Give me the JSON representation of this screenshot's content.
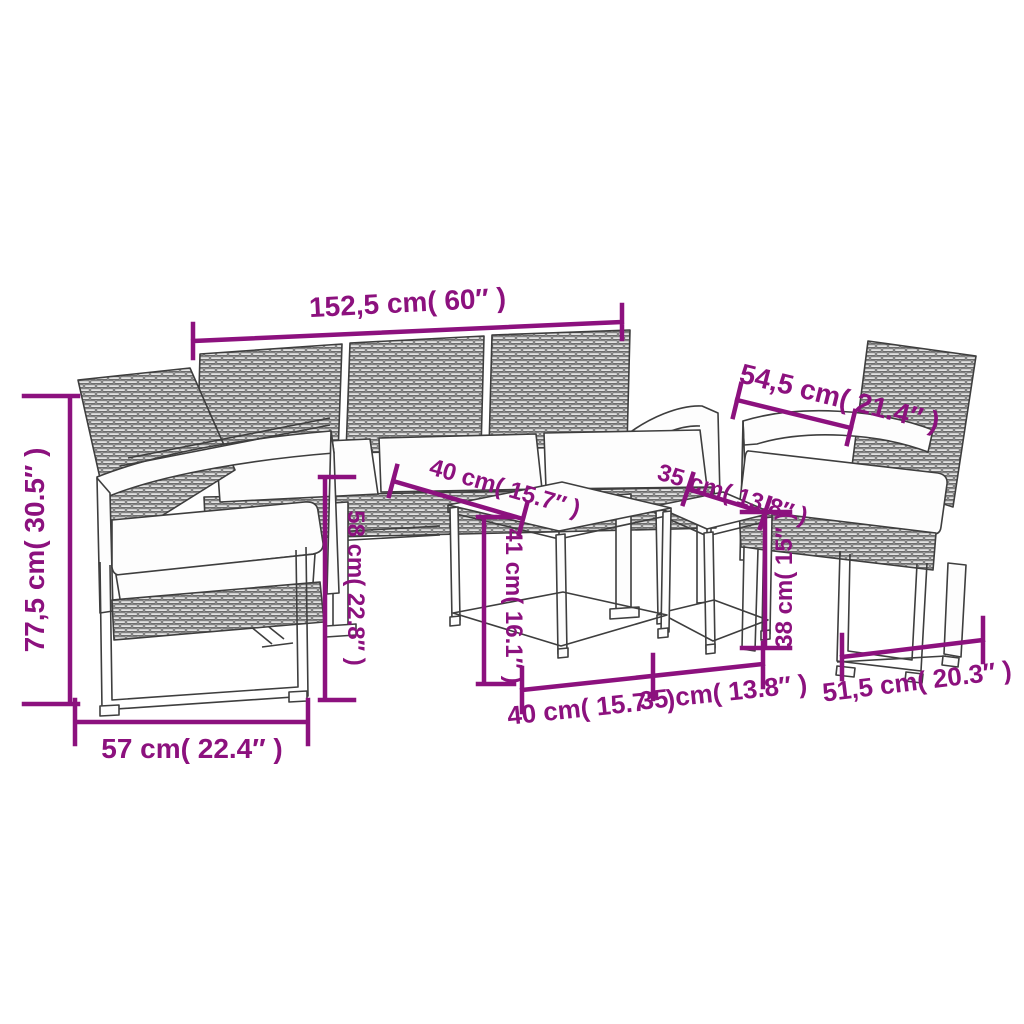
{
  "diagram": {
    "type": "product-dimension-diagram",
    "subject": "garden furniture set: three-seater sofa, two armchairs, two nesting side tables",
    "background_color": "#ffffff",
    "outline_color": "#3e3e3e",
    "dimension_color": "#8C117E"
  },
  "dimensions": {
    "sofa_width": "152,5 cm( 60″ )",
    "armchair_depth_top": "54,5 cm( 21.4″ )",
    "overall_height": "77,5 cm( 30.5″ )",
    "seat_back_height": "58 cm( 22.8″ )",
    "large_table_depth": "40 cm( 15.7″ )",
    "small_table_depth": "35 cm( 13.8″ )",
    "large_table_height": "41 cm( 16.1″ )",
    "small_table_height": "38 cm( 15″ )",
    "armchair_width": "57 cm( 22.4″ )",
    "large_table_width": "40 cm( 15.7″ )",
    "small_table_width": "35 cm( 13.8″ )",
    "armchair_depth_bottom": "51,5 cm( 20.3″ )"
  }
}
